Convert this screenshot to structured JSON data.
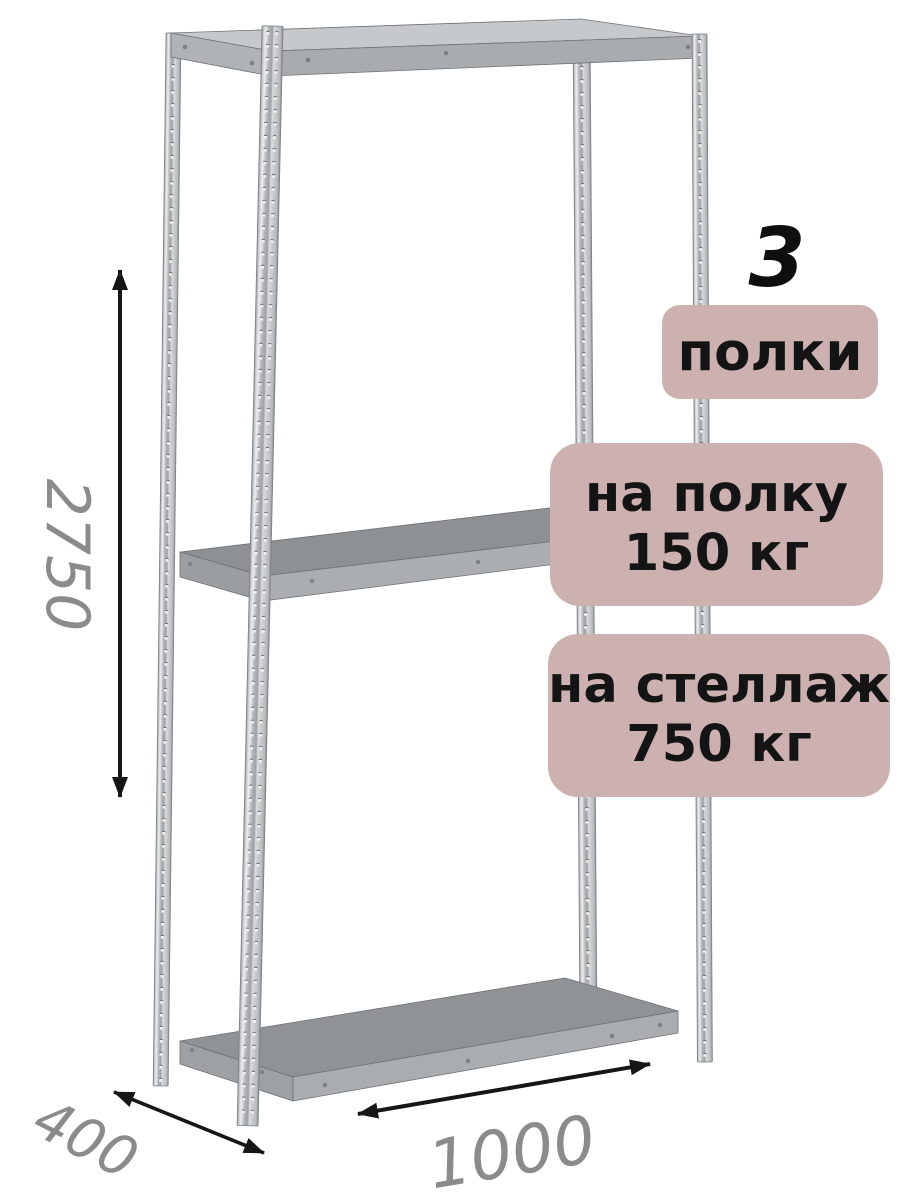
{
  "badges": {
    "count_number": "3",
    "count_label": "полки",
    "shelf_load_line1": "на полку",
    "shelf_load_line2": "150 кг",
    "rack_load_line1": "на стеллаж",
    "rack_load_line2": "750 кг"
  },
  "dimensions": {
    "height": "2750",
    "depth": "400",
    "width": "1000"
  },
  "colors": {
    "background": "#ffffff",
    "badge_background": "#cdb0b0",
    "badge_text": "#141414",
    "count_number_text": "#0f0f0f",
    "dimension_text": "#8b8b8b",
    "arrow": "#161616",
    "metal_highlight": "#eceeef",
    "metal_base": "#b2b5b7",
    "metal_edge": "#7e8184",
    "shelf_top_surface": "#c6c9cb",
    "shelf_mid_surface": "#8d9194",
    "shelf_band": "#a9adb0"
  }
}
